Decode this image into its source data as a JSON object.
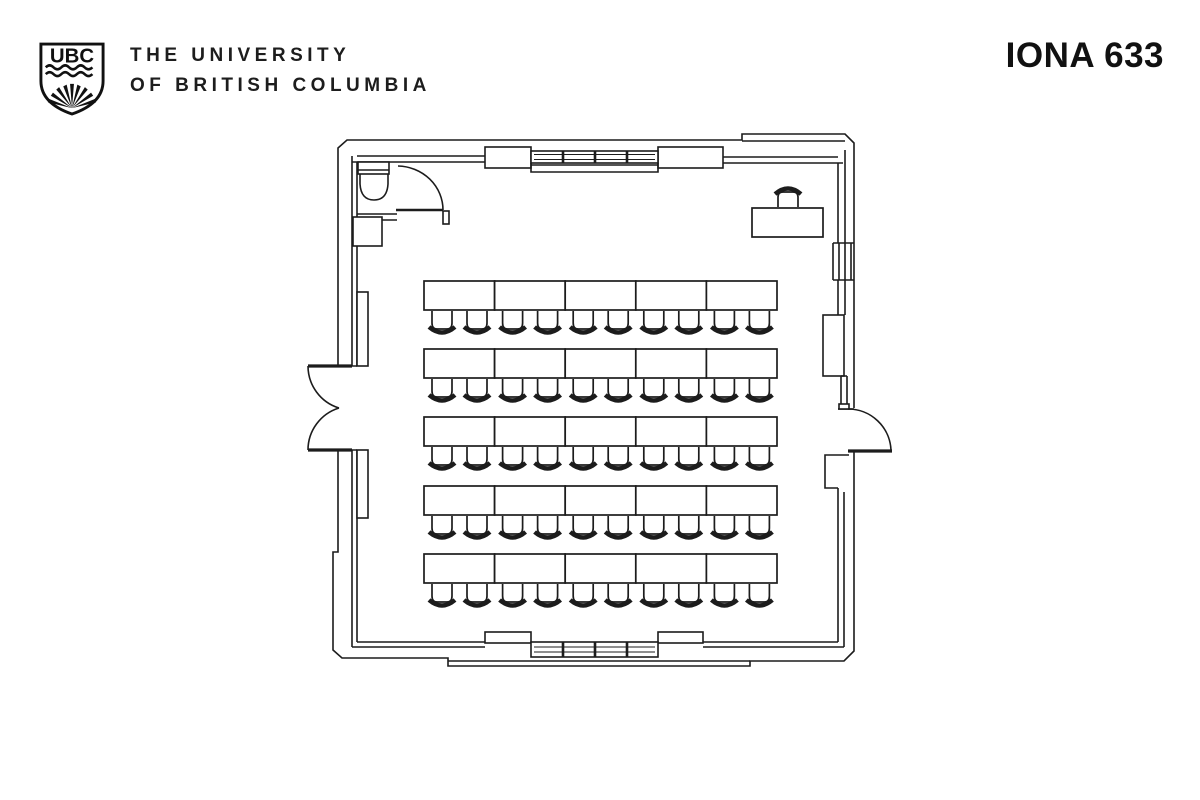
{
  "header": {
    "logo_text": "UBC",
    "university_line1": "THE UNIVERSITY",
    "university_line2": "OF BRITISH COLUMBIA",
    "room_label": "IONA 633"
  },
  "floor_plan": {
    "room_name": "IONA 633",
    "line_color": "#1c1c1c",
    "furniture": {
      "rows": 5,
      "tables_per_row": 5,
      "chairs_per_table": 2,
      "total_student_seats": 50,
      "origin_x": 424,
      "table_w": 70.6,
      "table_h": 29,
      "row_ys": [
        281,
        349,
        417,
        486,
        554
      ],
      "chair_offsets": [
        18,
        53
      ],
      "instructor": {
        "table_x": 752,
        "table_y": 208,
        "table_w": 71,
        "table_h": 29,
        "chair_cx": 788
      }
    }
  }
}
